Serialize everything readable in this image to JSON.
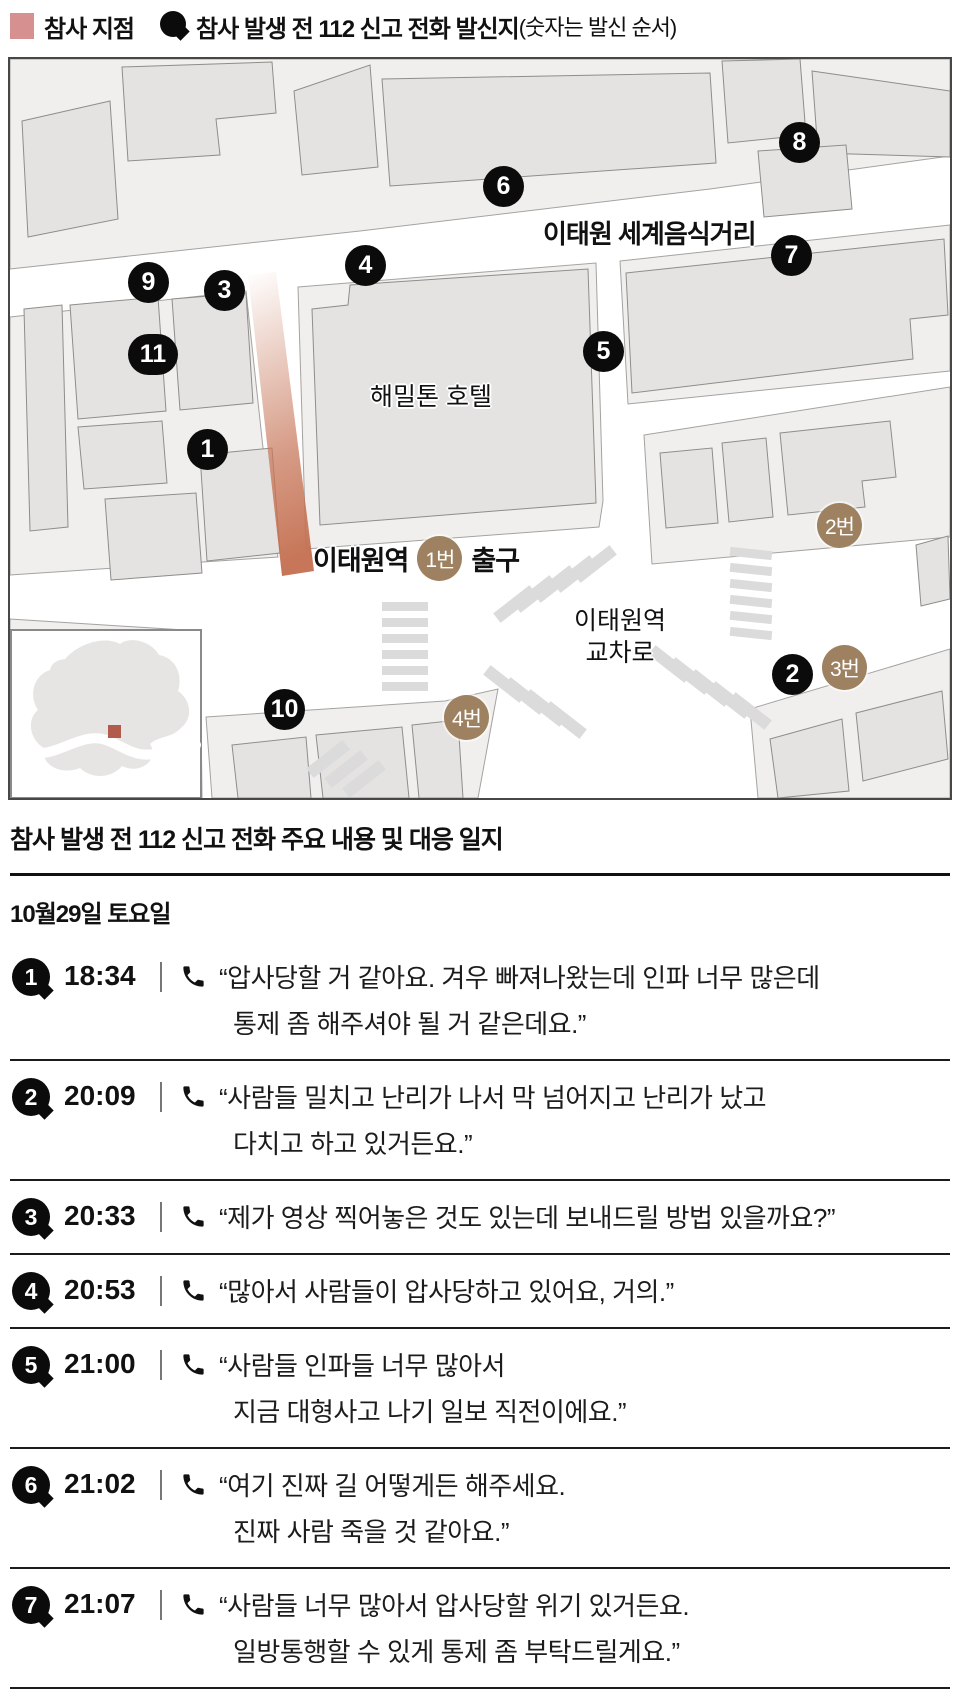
{
  "legend": {
    "disaster_label": "참사 지점",
    "call_label": "참사 발생 전 112 신고 전화 발신지",
    "call_note": "(숫자는 발신 순서)"
  },
  "colors": {
    "disaster_pink": "#d5908f",
    "alley_gradient": "#c8795c",
    "exit_brown": "#9d8160",
    "pin_black": "#0b0b0b",
    "inset_marker_red": "#b25b4a",
    "building_fill": "#e4e3e1",
    "block_ground": "#f0efed"
  },
  "map": {
    "street_label": "이태원 세계음식거리",
    "hotel_label": "해밀톤 호텔",
    "station_label": "이태원역",
    "exit_word": "출구",
    "crossing_line1": "이태원역",
    "crossing_line2": "교차로",
    "pins": [
      "1",
      "2",
      "3",
      "4",
      "5",
      "6",
      "7",
      "8",
      "9",
      "10",
      "11"
    ],
    "exits": [
      "1번",
      "2번",
      "3번",
      "4번"
    ]
  },
  "timeline": {
    "title": "참사 발생 전 112 신고 전화 주요 내용 및 대응 일지",
    "date": "10월29일 토요일",
    "calls": [
      {
        "num": "1",
        "time": "18:34",
        "line1": "“압사당할 거 같아요. 겨우 빠져나왔는데 인파 너무 많은데",
        "line2": "통제 좀 해주셔야 될 거 같은데요.”"
      },
      {
        "num": "2",
        "time": "20:09",
        "line1": "“사람들 밀치고 난리가 나서 막 넘어지고 난리가 났고",
        "line2": "다치고 하고 있거든요.”"
      },
      {
        "num": "3",
        "time": "20:33",
        "line1": "“제가 영상 찍어놓은 것도 있는데 보내드릴 방법 있을까요?”",
        "line2": ""
      },
      {
        "num": "4",
        "time": "20:53",
        "line1": "“많아서 사람들이 압사당하고 있어요, 거의.”",
        "line2": ""
      },
      {
        "num": "5",
        "time": "21:00",
        "line1": "“사람들 인파들 너무 많아서",
        "line2": "지금 대형사고 나기 일보 직전이에요.”"
      },
      {
        "num": "6",
        "time": "21:02",
        "line1": "“여기 진짜 길 어떻게든 해주세요.",
        "line2": "진짜 사람 죽을 것 같아요.”"
      },
      {
        "num": "7",
        "time": "21:07",
        "line1": "“사람들 너무 많아서 압사당할 위기 있거든요.",
        "line2": "일방통행할 수 있게 통제 좀 부탁드릴게요.”"
      }
    ]
  }
}
